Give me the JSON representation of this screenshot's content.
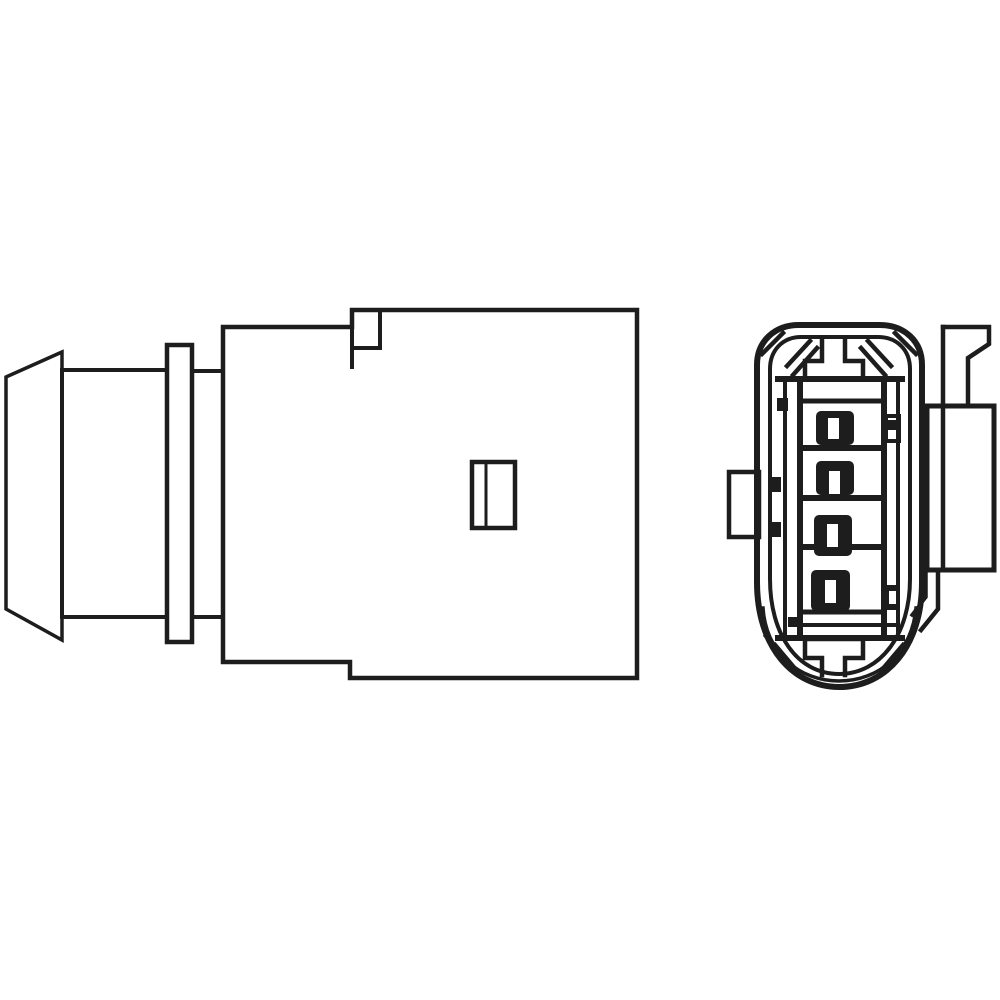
{
  "title": "Technical line drawing of an automotive oxygen (lambda) sensor plug with 4-pin connector",
  "colors": {
    "line": "#1d1d1d",
    "background": "#ffffff"
  },
  "drawing": {
    "style": "black-and-white outline product drawing, no text, no dimensions",
    "views": {
      "side_view": {
        "label": "sensor connector housing - side view",
        "parts": [
          "protective end cap",
          "sensor body",
          "mounting flange disc",
          "neck",
          "connector housing with stepped corners",
          "latch window detail"
        ]
      },
      "front_view": {
        "label": "connector face - front view",
        "terminal_count": "4",
        "parts": [
          "rounded outer shell",
          "inner shell wall",
          "top keying tab",
          "bottom keying tab",
          "corner hatch marks",
          "terminal cavity frame",
          "four dark terminal pins with contact slots",
          "left side tab",
          "right side bracket with angled release lever"
        ]
      }
    }
  }
}
